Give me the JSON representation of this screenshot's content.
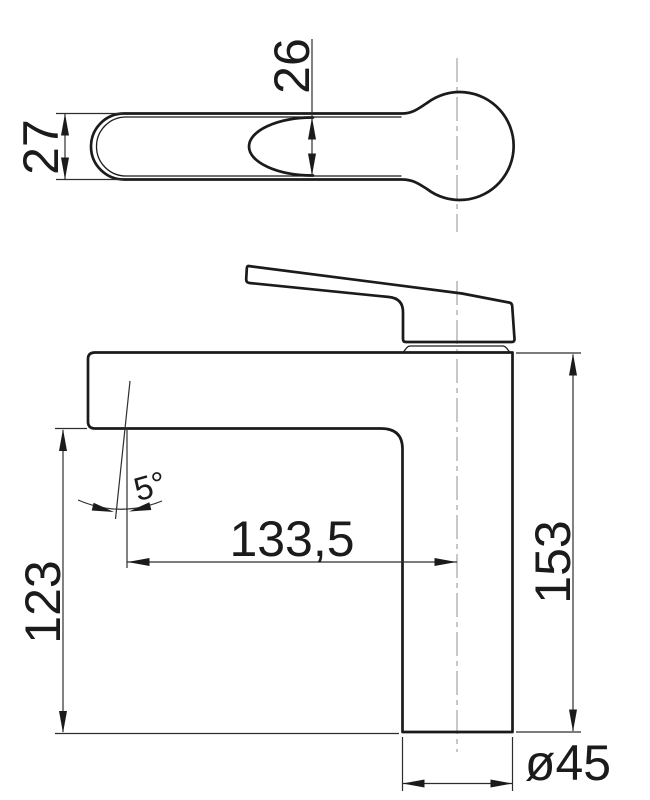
{
  "drawing": {
    "kind": "technical-dimension-drawing",
    "subject": "single-lever basin mixer faucet",
    "views": {
      "top_view": "handle seen from above",
      "side_view": "faucet body seen from the side"
    },
    "dimensions": {
      "handle_width": "27",
      "handle_inner_width": "26",
      "spout_reach": "133,5",
      "spout_height": "123",
      "total_height": "153",
      "spray_angle": "5°",
      "base_diameter": "ø45"
    },
    "colors": {
      "background": "#ffffff",
      "outline": "#1b1b1b",
      "dimension_lines": "#2e2e2e",
      "centerline": "#9b9b9b"
    }
  }
}
